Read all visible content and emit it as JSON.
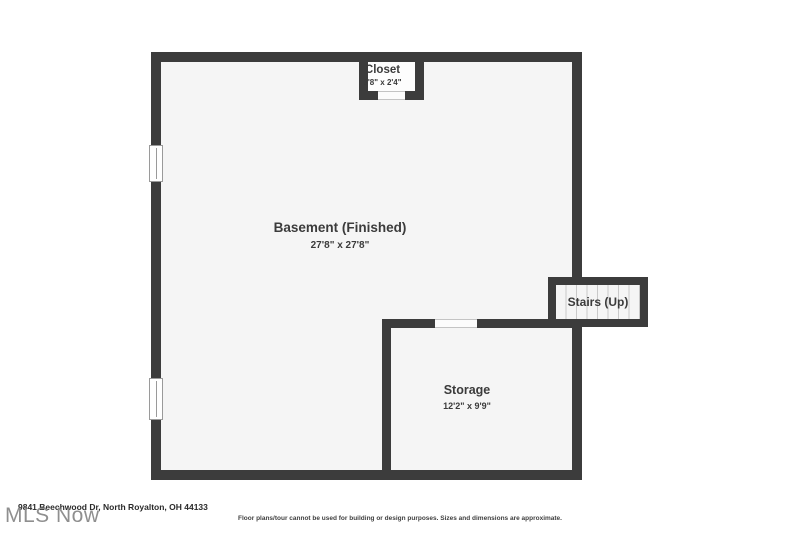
{
  "colors": {
    "wall": "#3c3c3c",
    "room_fill": "#f5f5f5",
    "closet_fill": "#fdfdfd",
    "step_line": "#c9c9c9",
    "label_text": "#3b3b3b"
  },
  "floor_plan": {
    "basement": {
      "name": "Basement (Finished)",
      "dimensions": "27'8\" x 27'8\""
    },
    "closet": {
      "name": "Closet",
      "dimensions": "3'8\" x 2'4\""
    },
    "stairs": {
      "name": "Stairs (Up)"
    },
    "storage": {
      "name": "Storage",
      "dimensions": "12'2\" x 9'9\""
    }
  },
  "footer": {
    "address": "9841 Beechwood Dr, North Royalton, OH 44133",
    "watermark": "MLS Now",
    "disclaimer": "Floor plans/tour cannot be used for building or design purposes. Sizes and dimensions are approximate."
  }
}
